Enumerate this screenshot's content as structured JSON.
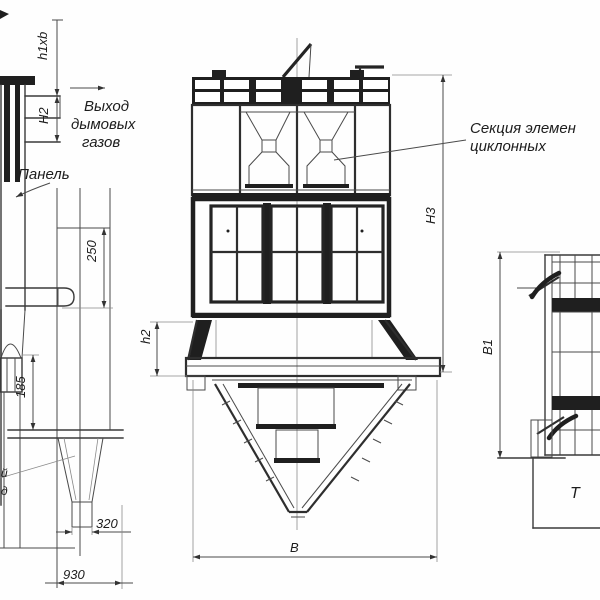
{
  "drawing_type": "engineering-drawing-battery-cyclone",
  "colors": {
    "background": "#fefefe",
    "line": "#3a3a3a",
    "dark_fill": "#1f1f1f"
  },
  "labels": {
    "gas_outlet": [
      "Выход",
      "дымовых",
      "газов"
    ],
    "panel": "Панель",
    "cyclone_section": [
      "Секция элемен",
      "циклонных"
    ],
    "edge_fragment_left": [
      "й",
      "д"
    ],
    "edge_fragment_right": "Т"
  },
  "dimensions": {
    "outlet_opening": "h1xb",
    "outlet_height": "Н2",
    "d250": "250",
    "d185": "185",
    "d320": "320",
    "d930": "930",
    "transition_height": "h2",
    "total_height": "Н3",
    "width": "В",
    "depth": "В1"
  }
}
